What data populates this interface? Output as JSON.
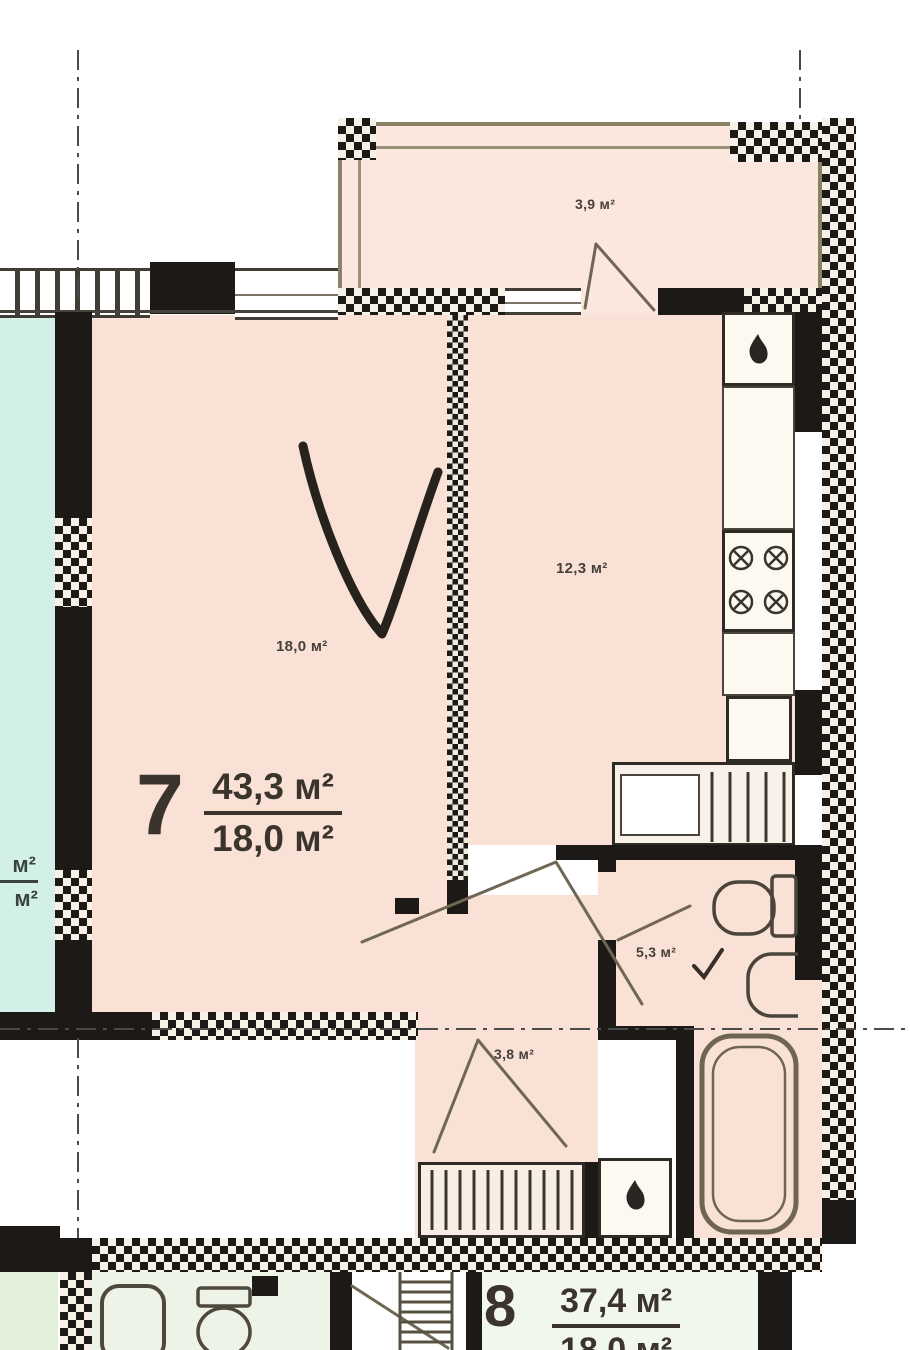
{
  "colors": {
    "wall": "#1c1916",
    "room": "#f9e1d6",
    "balcony": "#fbe7dd",
    "neighbor": "#d2efe8",
    "green": "#e2efd9",
    "green2": "#edf3e6",
    "room8": "#f2f7ed",
    "railing": "#8b8266",
    "line": "#6f6754",
    "text": "#46403a"
  },
  "apartment7": {
    "number": "7",
    "area_total": "43,3 м²",
    "area_living": "18,0 м²",
    "rooms": {
      "living": "18,0 м²",
      "kitchen": "12,3 м²",
      "bathroom": "5,3 м²",
      "hall": "3,8 м²",
      "balcony": "3,9 м²"
    }
  },
  "apartment8": {
    "number": "8",
    "area_total": "37,4 м²",
    "area_living": "18,0 м²"
  },
  "neighbor_label_fragment": {
    "top": "м²",
    "bottom": "м²"
  },
  "annotation_checkmark": true
}
